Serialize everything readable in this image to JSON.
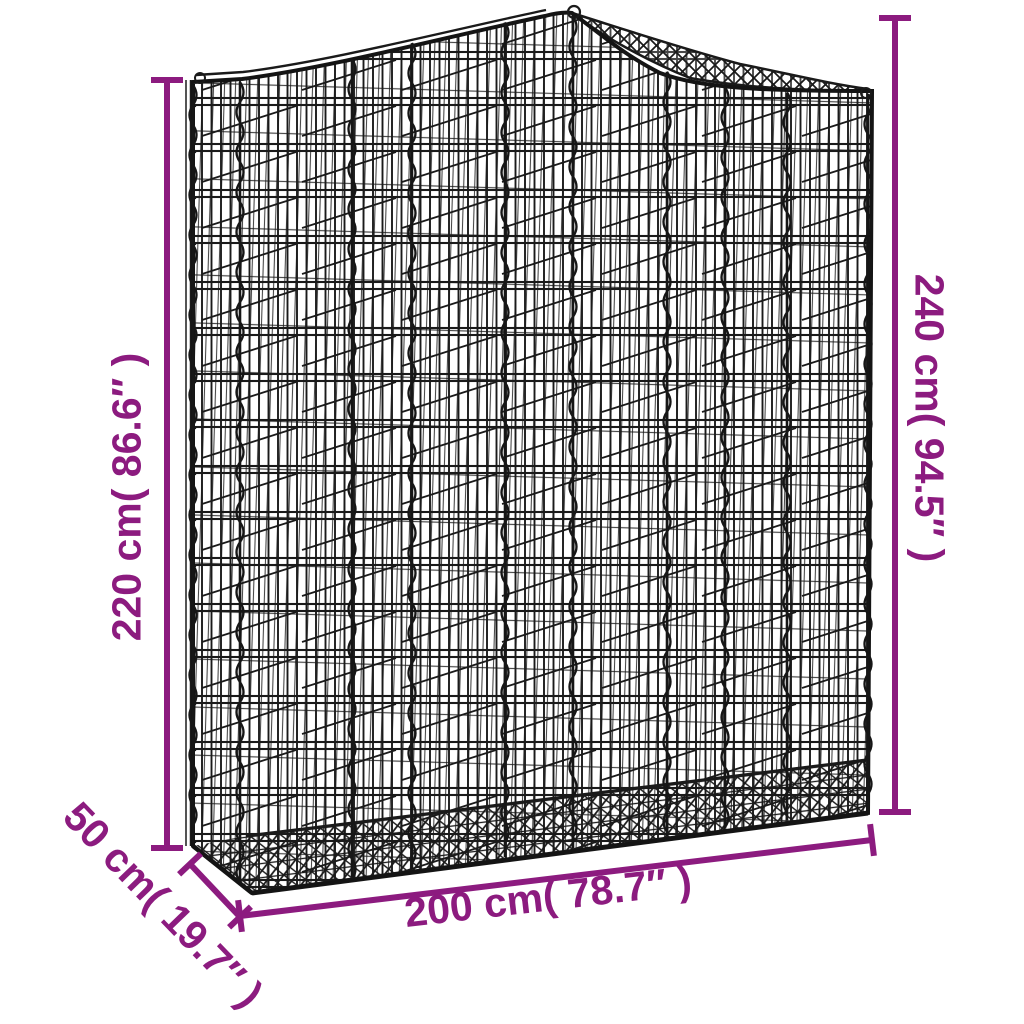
{
  "figure": {
    "kind": "product-dimension-diagram",
    "subject": "arched-gabion-mesh-basket"
  },
  "colors": {
    "annotation": "#8c1b7f",
    "wire": "#1a1a1a",
    "background": "#ffffff"
  },
  "dimensions": {
    "left_height": {
      "label": "220 cm( 86.6″ )"
    },
    "right_height": {
      "label": "240 cm( 94.5″ )"
    },
    "bottom_width": {
      "label": "200 cm( 78.7″ )"
    },
    "depth": {
      "label": "50 cm( 19.7″ )"
    }
  }
}
